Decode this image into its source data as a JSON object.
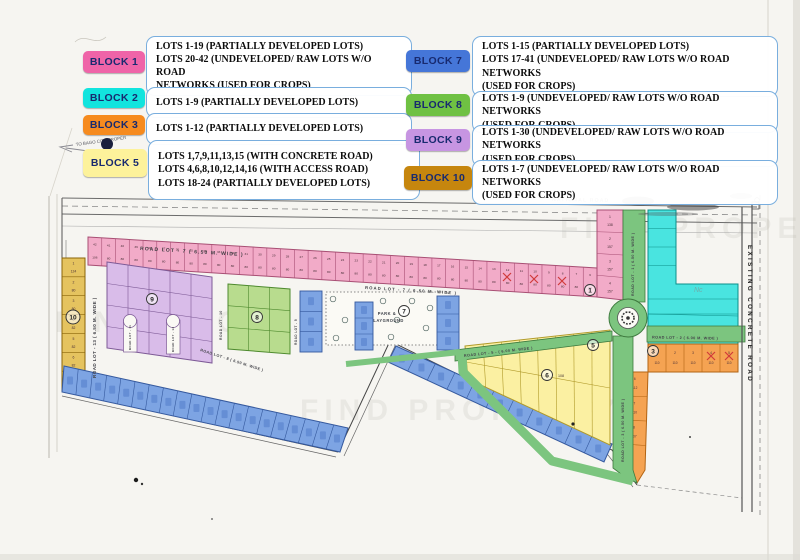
{
  "watermark": "FIND PROPERTY",
  "legend": {
    "items": [
      {
        "id": "block-1",
        "label": "BLOCK 1",
        "color": "#ef64a8",
        "lines": [
          "LOTS 1-19  (PARTIALLY DEVELOPED LOTS)",
          "LOTS 20-42 (UNDEVELOPED/ RAW LOTS W/O ROAD",
          "NETWORKS (USED FOR CROPS)"
        ]
      },
      {
        "id": "block-2",
        "label": "BLOCK 2",
        "color": "#12e4de",
        "lines": [
          "LOTS 1-9   (PARTIALLY DEVELOPED LOTS)"
        ]
      },
      {
        "id": "block-3",
        "label": "BLOCK 3",
        "color": "#f68b1f",
        "lines": [
          "LOTS 1-12  (PARTIALLY DEVELOPED LOTS)"
        ]
      },
      {
        "id": "block-5",
        "label": "BLOCK 5",
        "color": "#fdf29b",
        "lines": [
          "LOTS 1,7,9,11,13,15 (WITH CONCRETE ROAD)",
          "LOTS 4,6,8,10,12,14,16 (WITH ACCESS ROAD)",
          "LOTS 18-24 (PARTIALLY DEVELOPED LOTS)"
        ]
      },
      {
        "id": "block-7",
        "label": "BLOCK 7",
        "color": "#4576d8",
        "lines": [
          "LOTS 1-15  (PARTIALLY DEVELOPED LOTS)",
          "LOTS 17-41 (UNDEVELOPED/ RAW LOTS W/O ROAD NETWORKS",
          "(USED FOR CROPS)"
        ]
      },
      {
        "id": "block-8",
        "label": "BLOCK 8",
        "color": "#6fc143",
        "lines": [
          "LOTS 1-9 (UNDEVELOPED/ RAW LOTS W/O ROAD NETWORKS",
          "(USED FOR CROPS)"
        ]
      },
      {
        "id": "block-9",
        "label": "BLOCK 9",
        "color": "#c795e2",
        "lines": [
          "LOTS 1-30 (UNDEVELOPED/ RAW LOTS W/O ROAD NETWORKS",
          "(USED FOR CROPS)"
        ]
      },
      {
        "id": "block-10",
        "label": "BLOCK 10",
        "color": "#c6860e",
        "lines": [
          "LOTS 1-7 (UNDEVELOPED/ RAW LOTS W/O ROAD NETWORKS",
          "(USED FOR CROPS)"
        ]
      }
    ]
  },
  "map": {
    "annotations": {
      "to_bago": "TO BAGO CITY PROPER",
      "national_road": "NATIONAL ROAD",
      "concrete_road": "EXISTING CONCRETE ROAD",
      "park_line1": "PARK &",
      "park_line2": "PLAYGROUND",
      "artifact": "Nc"
    },
    "roads": {
      "r7a": "ROAD LOT - 7  ( 6.50 M. WIDE )",
      "r7b": "ROAD LOT - 7  ( 6.50 M. WIDE )",
      "r13": "ROAD LOT - 13  ( 6.50 M. WIDE )",
      "r10": "ROAD LOT - 10",
      "r9": "ROAD LOT - 9",
      "r11": "ROAD LOT - 11",
      "r12": "ROAD LOT - 12",
      "r1": "ROAD LOT - 1  ( 6.50 M. WIDE )",
      "r2": "ROAD LOT - 2  ( 6.00 M. WIDE )",
      "r3": "ROAD LOT - 3  ( 6.50 M. WIDE )",
      "r5": "ROAD LOT - 5 -  ( 6.00 M. WIDE )",
      "r8": "ROAD LOT - 8  ( 6.50 M. WIDE )"
    },
    "markers": {
      "b1": "1",
      "b3": "3",
      "b5": "5",
      "b6": "6",
      "b7": "7",
      "b8": "8",
      "b9": "9",
      "b10": "10"
    },
    "lot6_area": "108",
    "strips": {
      "block1_row": {
        "numbers": [
          "42",
          "41",
          "40",
          "39",
          "38",
          "37",
          "36",
          "35",
          "34",
          "33",
          "32",
          "31",
          "30",
          "29",
          "28",
          "27",
          "26",
          "25",
          "24",
          "23",
          "22",
          "21",
          "20",
          "19",
          "18",
          "17",
          "16",
          "15",
          "14",
          "13",
          "12",
          "11",
          "10",
          "9",
          "8",
          "7",
          "6"
        ],
        "areas": [
          "106",
          "80",
          "80",
          "80",
          "80",
          "80",
          "80",
          "80",
          "80",
          "80",
          "80",
          "80",
          "80",
          "80",
          "80",
          "80",
          "80",
          "80",
          "80",
          "80",
          "80",
          "80",
          "80",
          "80",
          "80",
          "80",
          "80",
          "80",
          "80",
          "80",
          "80",
          "80",
          "80",
          "80",
          "80",
          "80",
          "90"
        ]
      },
      "block1_col": {
        "numbers": [
          "1",
          "2",
          "3",
          "4"
        ],
        "areas": [
          "138",
          "157",
          "157",
          "157"
        ]
      },
      "block10_col": {
        "numbers": [
          "1",
          "2",
          "3",
          "4",
          "5",
          "6",
          "7"
        ],
        "areas": [
          "124",
          "80",
          "80",
          "82",
          "82",
          "82",
          "80"
        ]
      },
      "block3_row": {
        "numbers": [
          "1",
          "2",
          "3",
          "4",
          "5"
        ],
        "areas": [
          "110",
          "110",
          "110",
          "110",
          "110"
        ]
      },
      "block3_col": {
        "numbers": [
          "6",
          "7",
          "8",
          ""
        ],
        "areas": [
          "112",
          "110",
          "107",
          ""
        ]
      }
    }
  }
}
